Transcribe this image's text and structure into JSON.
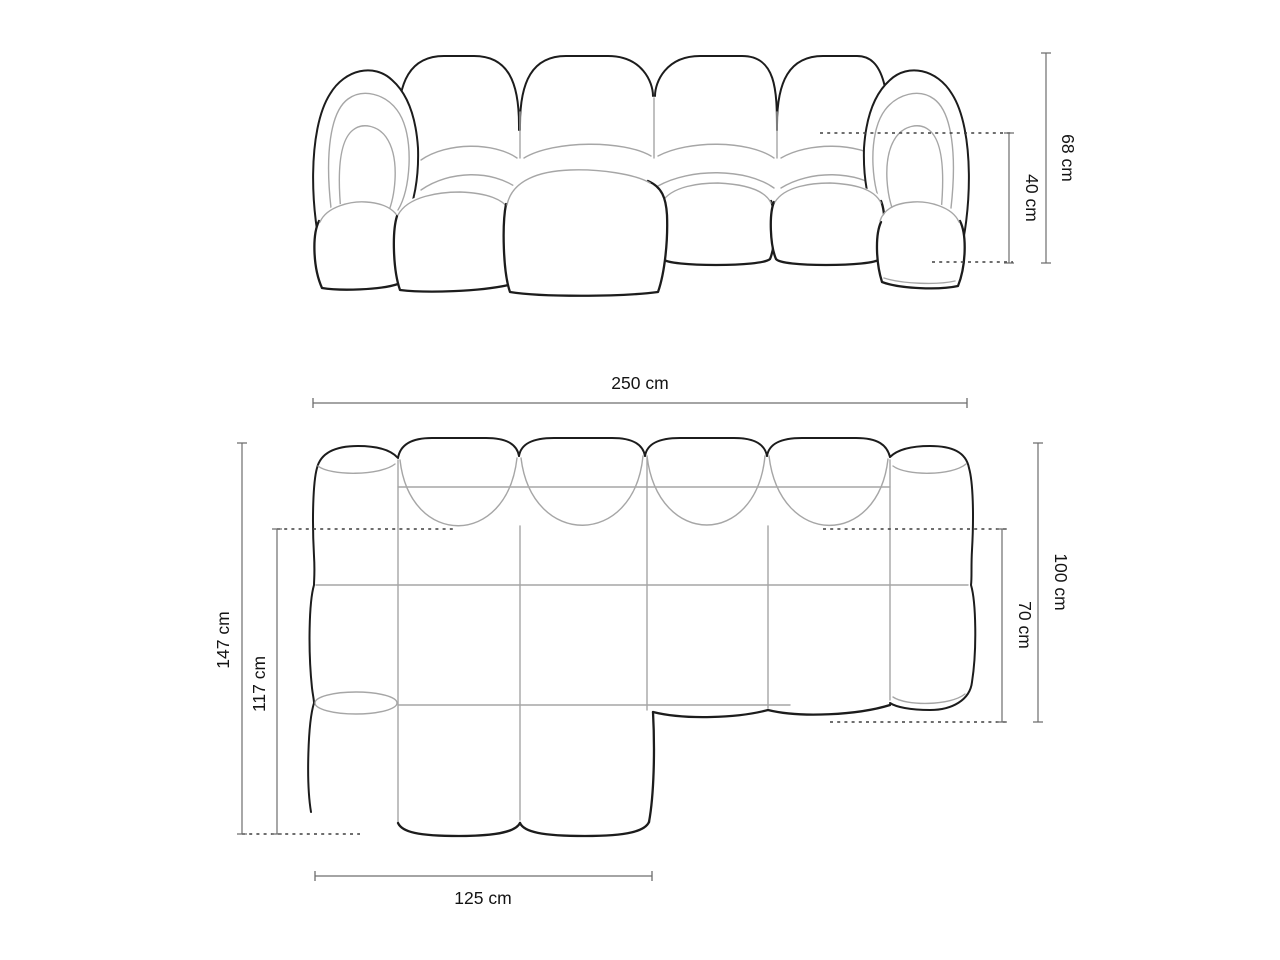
{
  "diagram": {
    "subject": "Modular bubble sectional sofa with left chaise - dimension drawing",
    "style": {
      "outline_color": "#1c1c1c",
      "seam_color": "#a6a6a6",
      "dimension_line_color": "#6d6d6d",
      "dashed_line_color": "#3f3f3f",
      "background": "#ffffff"
    },
    "front_view": {
      "name": "front elevation",
      "dimensions": {
        "total_height": "68 cm",
        "seat_height": "40 cm"
      }
    },
    "top_view": {
      "name": "plan view",
      "dimensions": {
        "total_width": "250 cm",
        "total_depth": "147 cm",
        "chaise_inner_depth": "117 cm",
        "chaise_width": "125 cm",
        "body_depth": "100 cm",
        "seat_depth": "70 cm"
      }
    }
  }
}
